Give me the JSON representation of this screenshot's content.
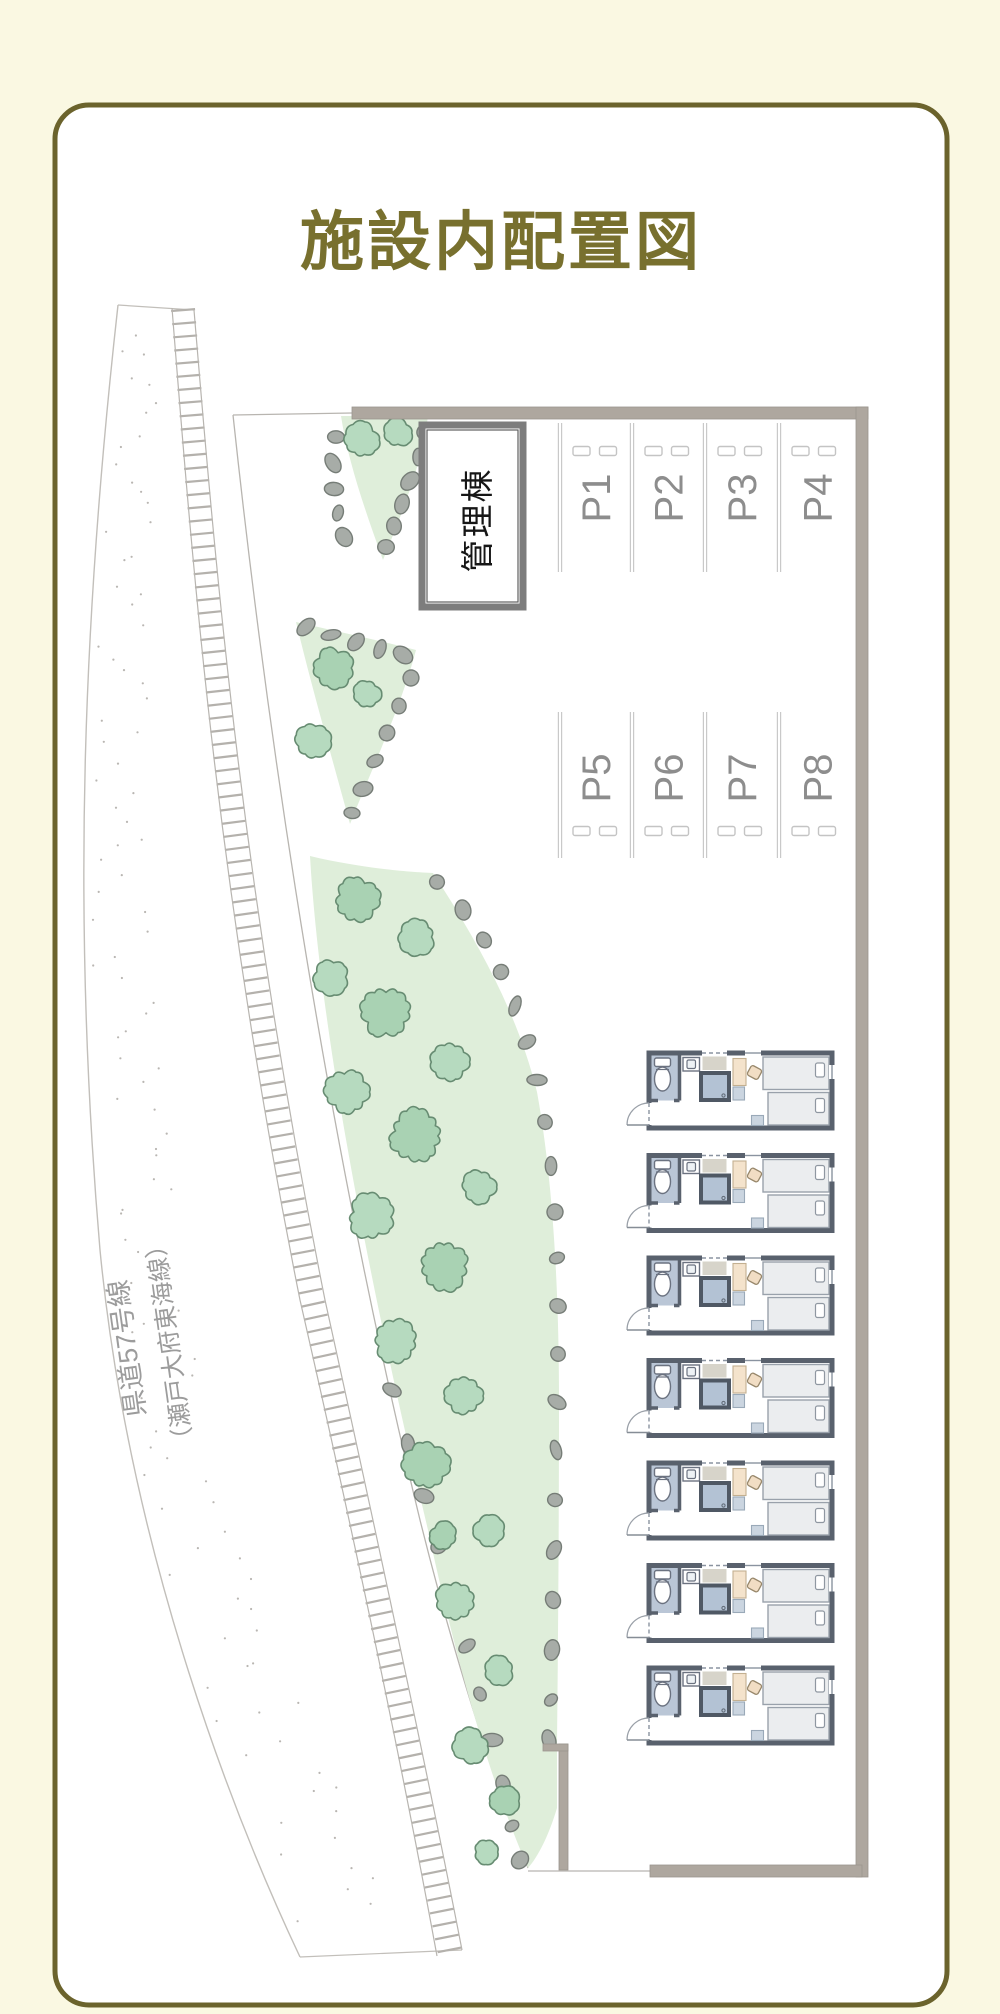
{
  "page": {
    "title": "施設内配置図"
  },
  "map": {
    "road": {
      "name_line1": "県道57号線",
      "name_line2": "（瀬戸大府東海線）"
    },
    "building": {
      "label": "管理棟"
    },
    "parking": {
      "spots": [
        "P1",
        "P2",
        "P3",
        "P4",
        "P5",
        "P6",
        "P7",
        "P8"
      ]
    },
    "units": {
      "count": 7
    },
    "colors": {
      "background": "#faf8e2",
      "card_border": "#6b632c",
      "title": "#78702e",
      "wall_gray": "#aea79f",
      "green": "#dfeeda",
      "tree": "#b6dabf",
      "stone": "#a7aca7",
      "parking_label": "#8d8d8d",
      "road_line": "#c2bfba",
      "unit_wall": "#59616d"
    }
  }
}
